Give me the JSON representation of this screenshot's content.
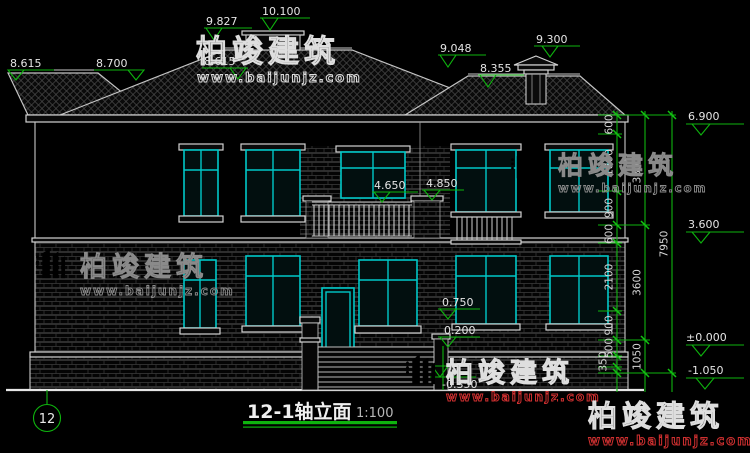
{
  "titleblock": {
    "title": "12-1轴立面",
    "scale": "1:100",
    "axis": "12"
  },
  "watermark": {
    "brand": "柏竣建筑",
    "site": "www.baijunjz.com"
  },
  "levels": {
    "left_eave": "8.615",
    "left_eave2": "8.700",
    "ridge": "9.827",
    "parapet_top": "10.100",
    "center_eave": "8.615",
    "right_eave": "9.048",
    "chimney_base": "8.355",
    "chimney_top": "9.300",
    "main_eave": "6.900",
    "second_floor": "3.600",
    "zero": "±0.000",
    "site_ground": "-1.050",
    "balcony_rail": "4.650",
    "balcony_pier": "4.850",
    "porch_wall": "0.750",
    "porch": "0.200",
    "step": "-0.350"
  },
  "dims": {
    "inner": [
      "600",
      "1800",
      "900",
      "600",
      "2100",
      "900",
      "500",
      "350"
    ],
    "middle": [
      "3300",
      "3600",
      "1050"
    ],
    "outer": [
      "7950"
    ]
  },
  "colors": {
    "background": "#000000",
    "line": "#c9c9c9",
    "dimension_green": "#0eb40e",
    "window_cyan": "#00c8c8",
    "url_red": "#d03030",
    "logo_blue": "#1d5fd0",
    "logo_orange": "#f59a1d"
  }
}
